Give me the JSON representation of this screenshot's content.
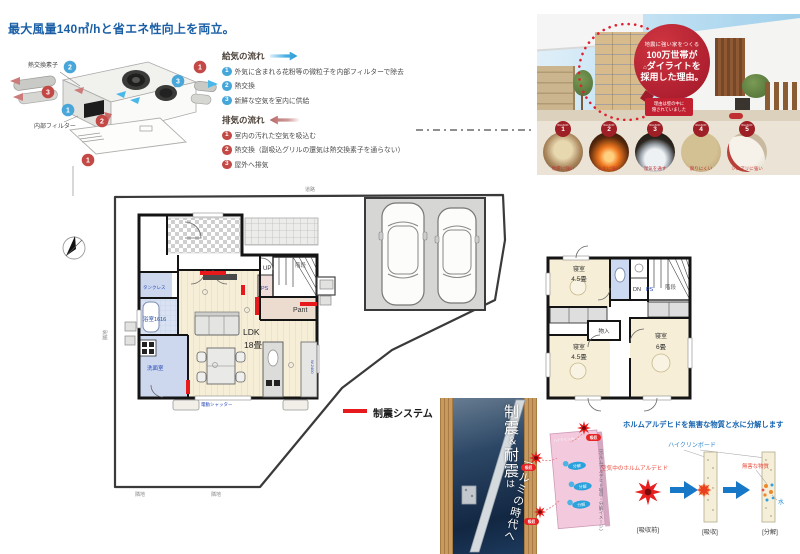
{
  "title": "最大風量140㎥/hと省エネ性向上を両立。",
  "nums": {
    "n1": "1",
    "n2": "2",
    "n3": "3"
  },
  "vent": {
    "heat_exchanger": "熱交換素子",
    "filter": "内部フィルター",
    "supply": {
      "heading": "給気の流れ",
      "items": [
        {
          "n": "1",
          "t": "外気に含まれる花粉等の微粒子を内部フィルターで除去"
        },
        {
          "n": "2",
          "t": "熱交換"
        },
        {
          "n": "3",
          "t": "新鮮な空気を室内に供給"
        }
      ]
    },
    "exhaust": {
      "heading": "排気の流れ",
      "items": [
        {
          "n": "1",
          "t": "室内の汚れた空気を吸込む"
        },
        {
          "n": "2",
          "t": "熱交換（副吸込グリルの還気は熱交換素子を通らない）"
        },
        {
          "n": "3",
          "t": "屋外へ排気"
        }
      ]
    }
  },
  "promo": {
    "badge_small": "地震に強い家をつくる",
    "badge_line1": "100万世帯が",
    "badge_icon": "⌂",
    "badge_line2": "ダイライトを",
    "badge_line3": "採用した理由。",
    "ribbon_line1": "理由は壁の中に",
    "ribbon_line2": "隠されていました",
    "reason_word": "REASON",
    "reasons": [
      {
        "num": "1",
        "caption": "地震に強い"
      },
      {
        "num": "2",
        "caption": "火災に強い"
      },
      {
        "num": "3",
        "caption": "湿気を通す"
      },
      {
        "num": "4",
        "caption": "腐りにくい"
      },
      {
        "num": "5",
        "caption": "シロアリに強い"
      }
    ]
  },
  "plan1f": {
    "ldk": "LDK",
    "ldk_size": "18畳",
    "pant": "Pant",
    "up": "UP",
    "stairs": "階段",
    "ps": "PS",
    "tankless": "タンクレス",
    "bath": "浴室1616",
    "wash": "洗面室",
    "shutter": "電動シャッター",
    "w2400": "W.2400",
    "road": "道路",
    "adjacent": "隣地"
  },
  "plan2f": {
    "bedroom": "寝室",
    "size45": "4.5畳",
    "size6": "6畳",
    "closet": "物入",
    "dn": "DN",
    "ps": "PS",
    "stairs": "階段"
  },
  "legend": {
    "label": "制震システム"
  },
  "banner": {
    "seishin": "制震",
    "amp": "＆",
    "taishin": "耐震",
    "ha": "は",
    "era": "アルミの時代へ"
  },
  "formaldehyde": {
    "title": "ホルムアルデヒドを無害な物質と水に分解します",
    "board": "ハイクリンボード",
    "air": "空気中のホルムアルデヒド",
    "harmless": "無害な物質",
    "water": "水",
    "absorb": "吸収",
    "decompose": "分解",
    "before": "[吸収前]",
    "absorbing": "[吸収]",
    "decomposed": "[分解]",
    "note": "（ホルムアルデヒド吸収・分解イメージ）"
  },
  "colors": {
    "accent_blue": "#1a5fa6",
    "damper_red": "#e8191c",
    "supply_blue": "#3fa9e0",
    "exhaust_red": "#c98f94",
    "badge_red": "#b02030"
  }
}
